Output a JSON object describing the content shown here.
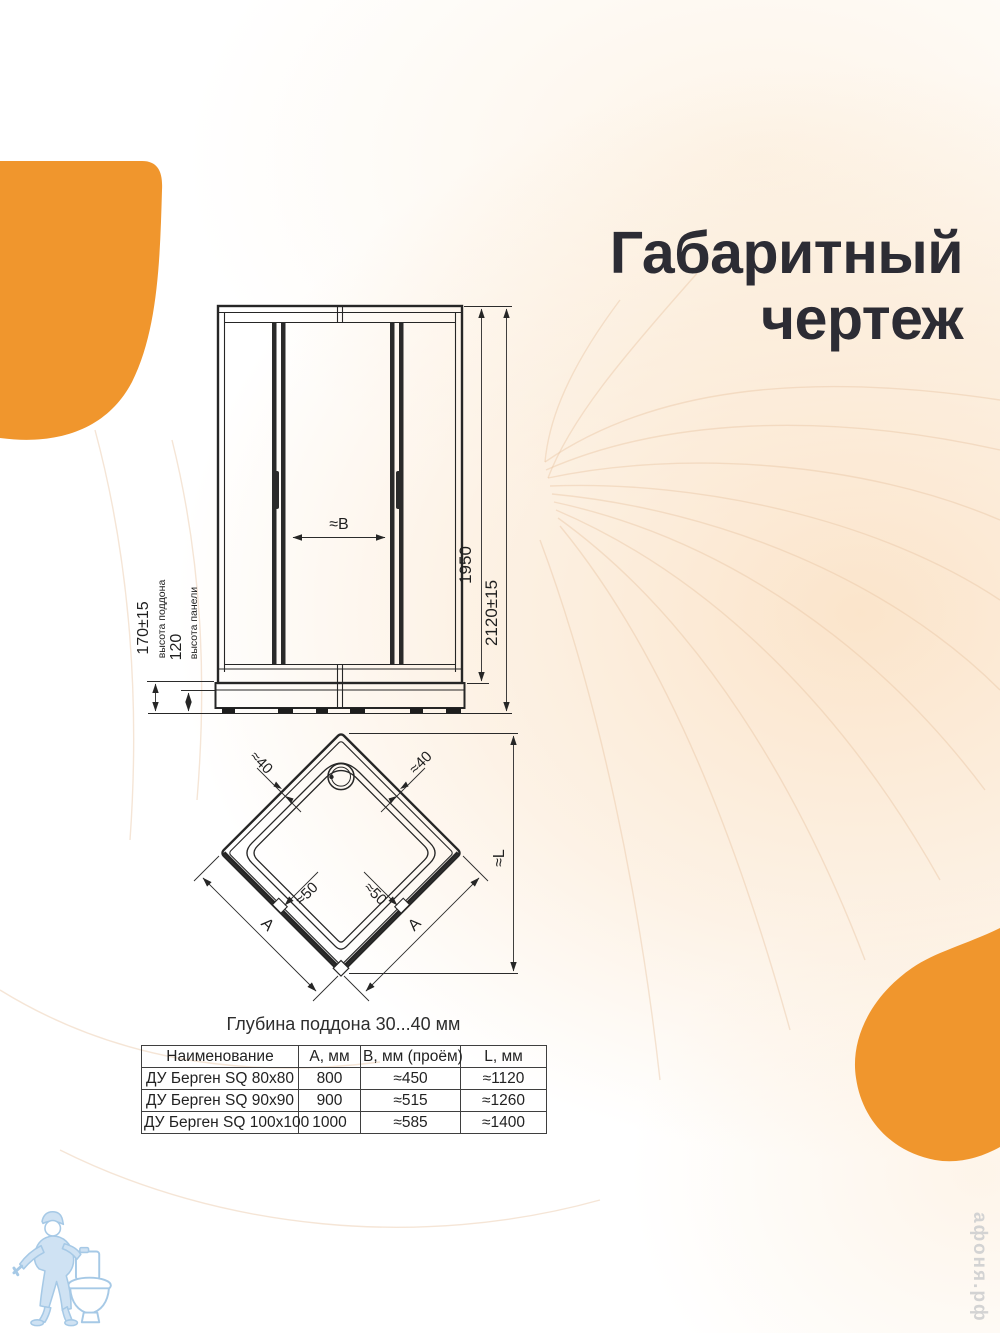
{
  "colors": {
    "accent_orange": "#F0962D",
    "drawing_line": "#262626",
    "title_text": "#2C2C34",
    "logo_blue": "#A6C9E6",
    "watermark_gray": "#D3D3D3"
  },
  "title": {
    "line1": "Габаритный",
    "line2": "чертеж"
  },
  "front_view": {
    "height_inner": "1950",
    "height_total": "2120±15",
    "tray_height": "170±15",
    "tray_height_label": "высота поддона",
    "panel_height": "120",
    "panel_height_label": "высота панели",
    "door_opening": "≈B"
  },
  "plan_view": {
    "profile_left": "≈40",
    "profile_right": "≈40",
    "offset_left": "≈50",
    "offset_right": "≈50",
    "side_left": "A",
    "side_right": "A",
    "diagonal": "≈L"
  },
  "caption": "Глубина поддона 30...40 мм",
  "table": {
    "headers": [
      "Наименование",
      "А, мм",
      "B, мм (проём)",
      "L, мм"
    ],
    "rows": [
      [
        "ДУ Берген SQ 80x80",
        "800",
        "≈450",
        "≈1120"
      ],
      [
        "ДУ Берген SQ 90x90",
        "900",
        "≈515",
        "≈1260"
      ],
      [
        "ДУ Берген SQ 100x100",
        "1000",
        "≈585",
        "≈1400"
      ]
    ]
  },
  "watermark": "афоня.рф"
}
